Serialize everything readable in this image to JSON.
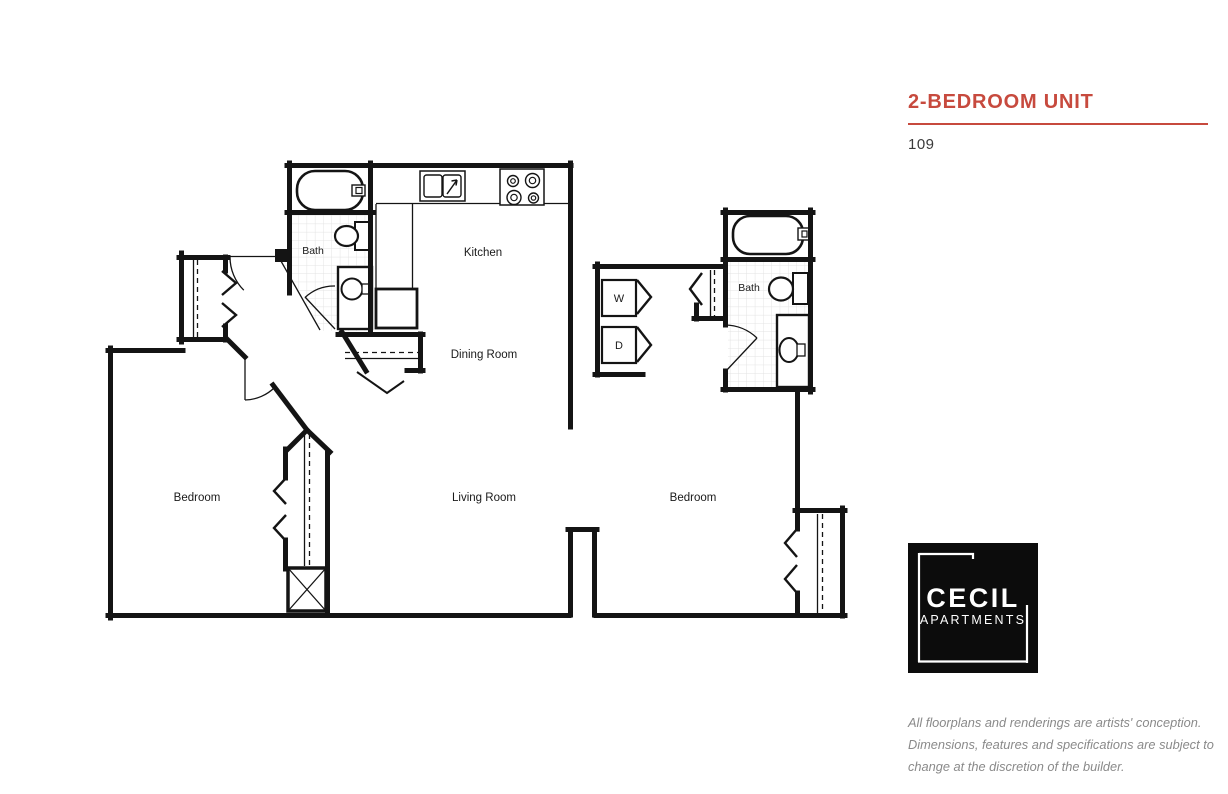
{
  "header": {
    "title": "2-BEDROOM UNIT",
    "unit_number": "109"
  },
  "colors": {
    "accent": "#c74a3e",
    "wall": "#141414",
    "tile_line": "#e3e3e3",
    "muted_text": "#8a8a8a"
  },
  "floorplan": {
    "labels": {
      "bath1": "Bath",
      "kitchen": "Kitchen",
      "dining": "Dining Room",
      "living": "Living Room",
      "bedroom1": "Bedroom",
      "bedroom2": "Bedroom",
      "bath2": "Bath",
      "washer": "W",
      "dryer": "D"
    }
  },
  "logo": {
    "name": "CECIL",
    "subtitle": "APARTMENTS"
  },
  "disclaimer": {
    "lines": [
      "All floorplans and renderings are artists' conception.",
      "Dimensions, features and specifications are subject to",
      "change at the discretion of the builder."
    ]
  }
}
